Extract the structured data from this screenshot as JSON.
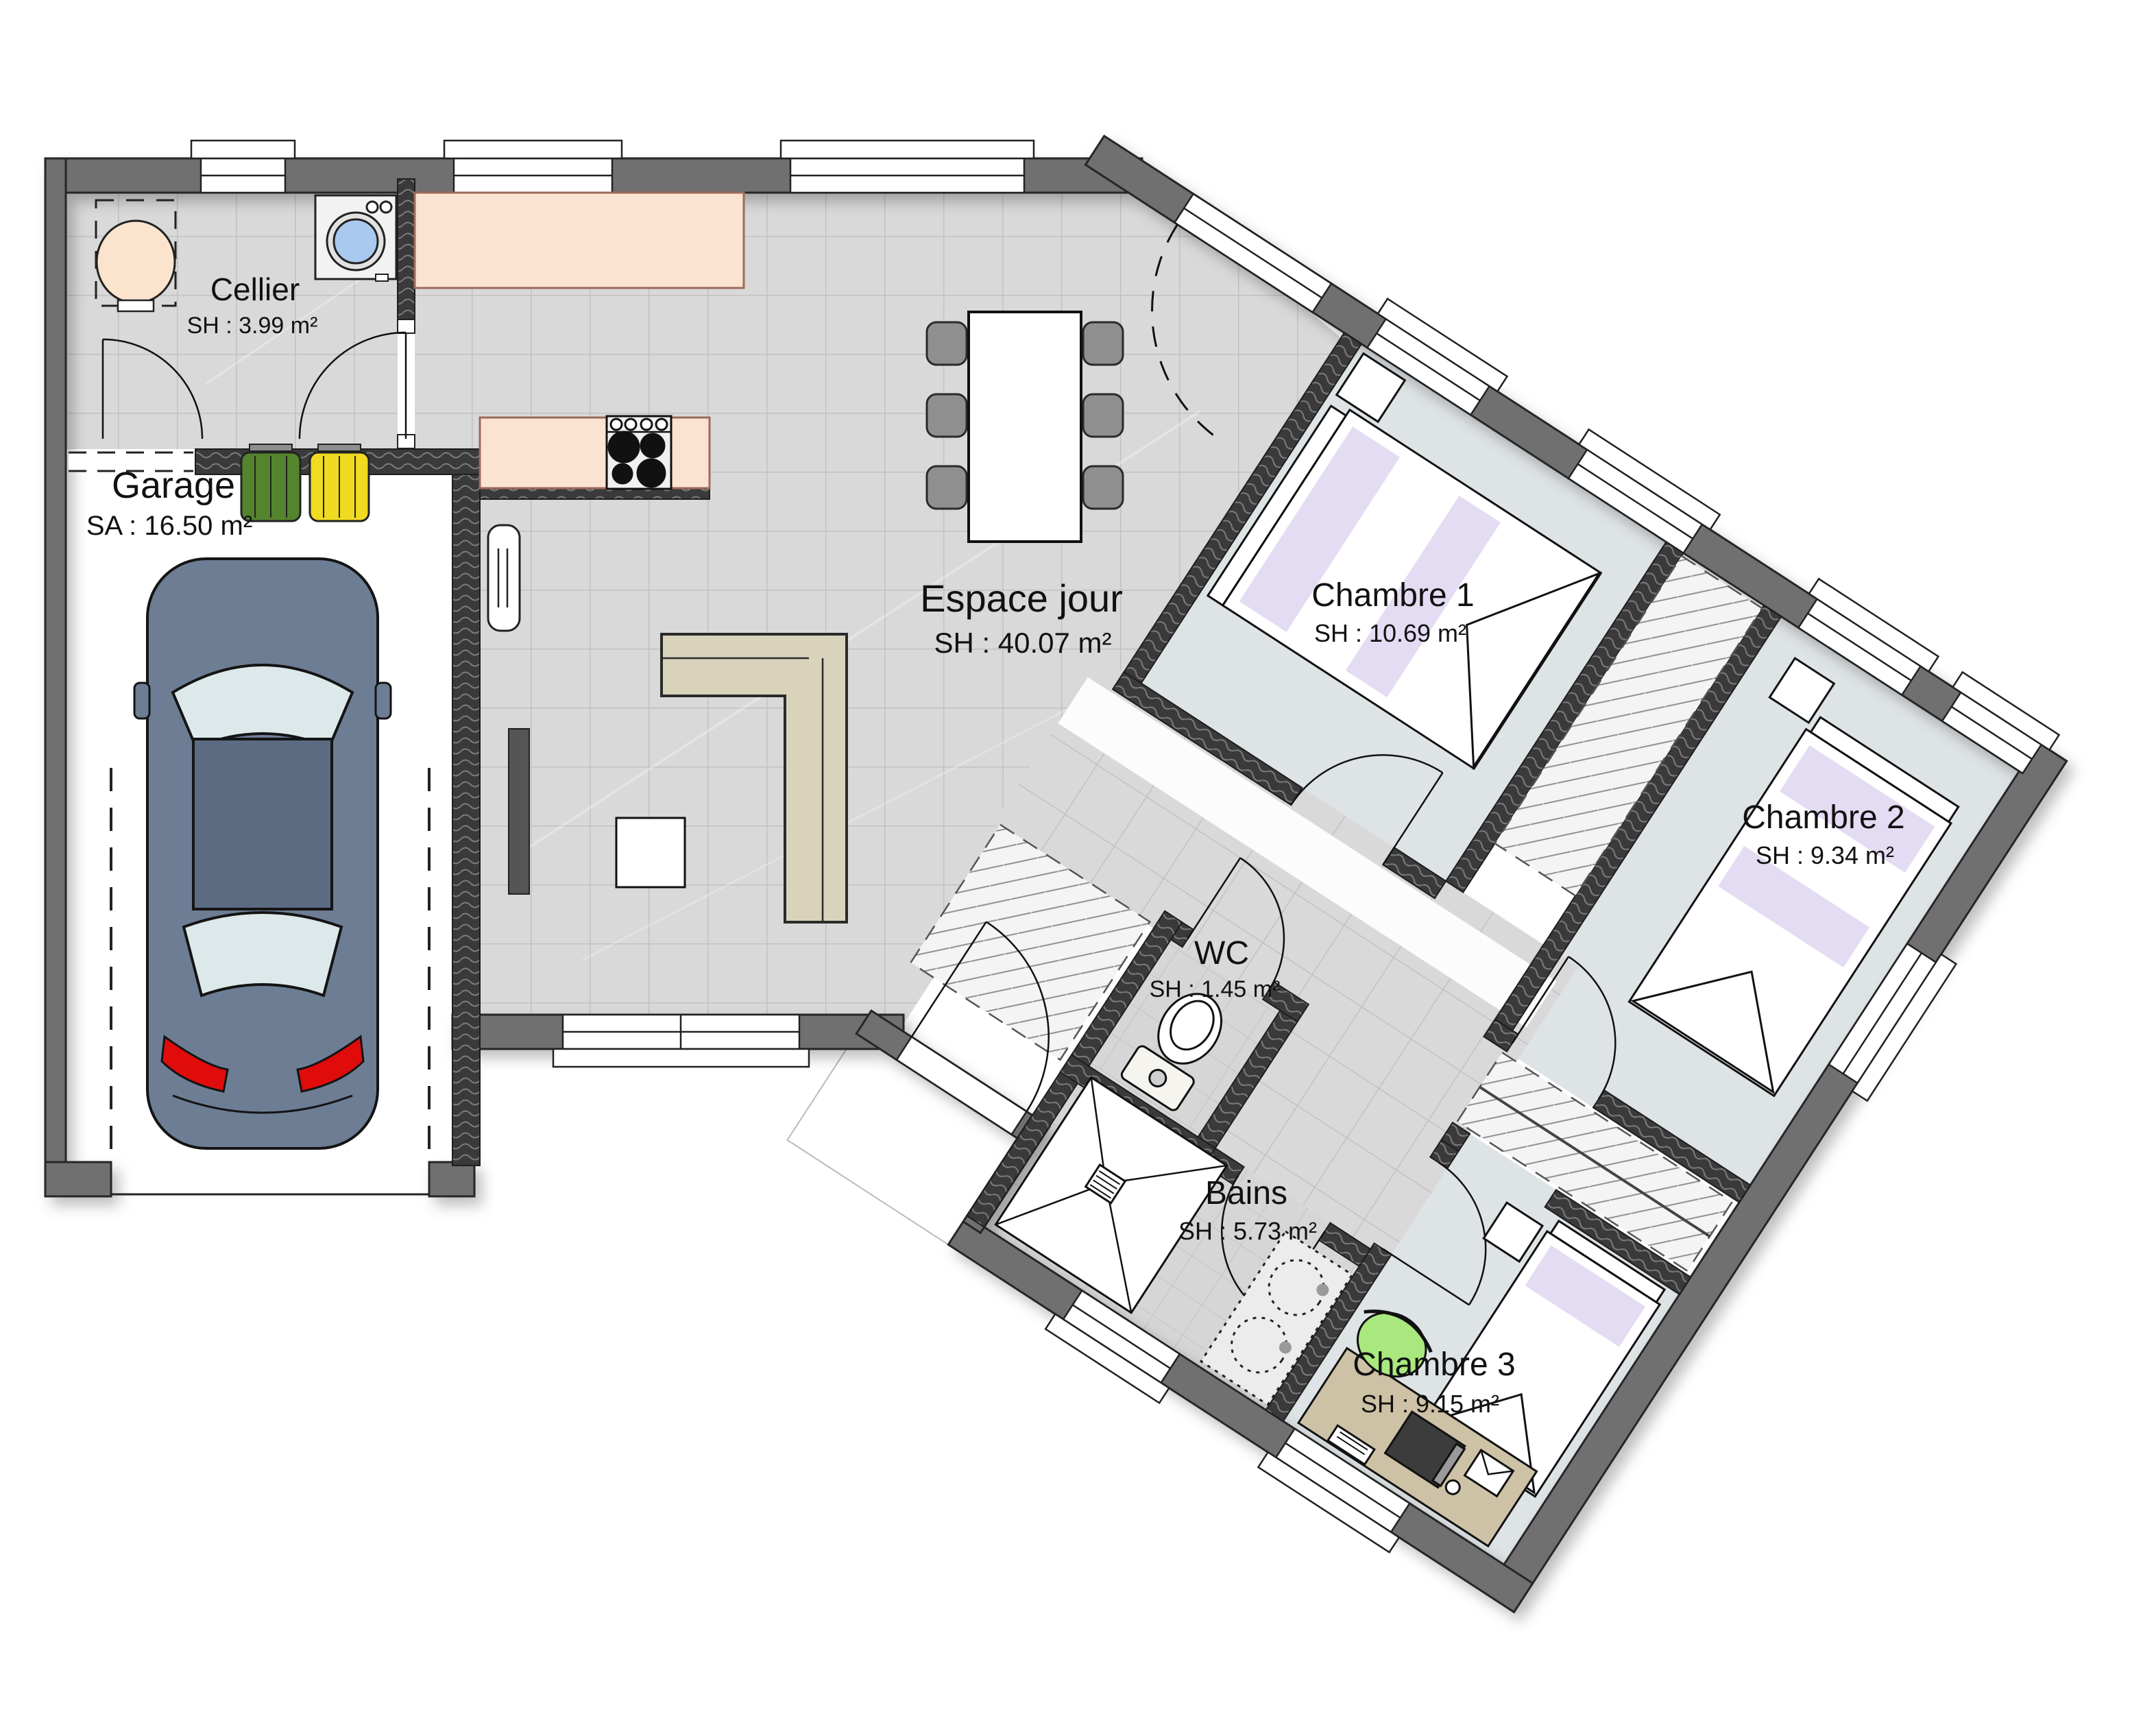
{
  "plan": {
    "rooms": [
      {
        "id": "cellier",
        "name": "Cellier",
        "area": "SH : 3.99 m²"
      },
      {
        "id": "garage",
        "name": "Garage",
        "area": "SA : 16.50 m²"
      },
      {
        "id": "espace-jour",
        "name": "Espace jour",
        "area": "SH : 40.07 m²"
      },
      {
        "id": "chambre-1",
        "name": "Chambre 1",
        "area": "SH : 10.69 m²"
      },
      {
        "id": "chambre-2",
        "name": "Chambre 2",
        "area": "SH : 9.34 m²"
      },
      {
        "id": "wc",
        "name": "WC",
        "area": "SH : 1.45 m²"
      },
      {
        "id": "bains",
        "name": "Bains",
        "area": "SH : 5.73 m²"
      },
      {
        "id": "chambre-3",
        "name": "Chambre 3",
        "area": "SH : 9.15 m²"
      }
    ],
    "colors": {
      "wall_exterior": "#6f6f6f",
      "wall_interior": "#3a3a3a",
      "floor_tile": "#d9d9d9",
      "floor_bedroom": "#dee3e6",
      "counter": "#fbe3d1",
      "sofa": "#d9d3bc",
      "car_body": "#6d7d94",
      "bin_green": "#55842e",
      "bin_yellow": "#f0da22",
      "accent_textile": "#e3dcf2",
      "taillight": "#e00b0b",
      "desk": "#cec2a6",
      "chair_green": "#a9e87e",
      "washer_door": "#a9c9ee"
    }
  }
}
